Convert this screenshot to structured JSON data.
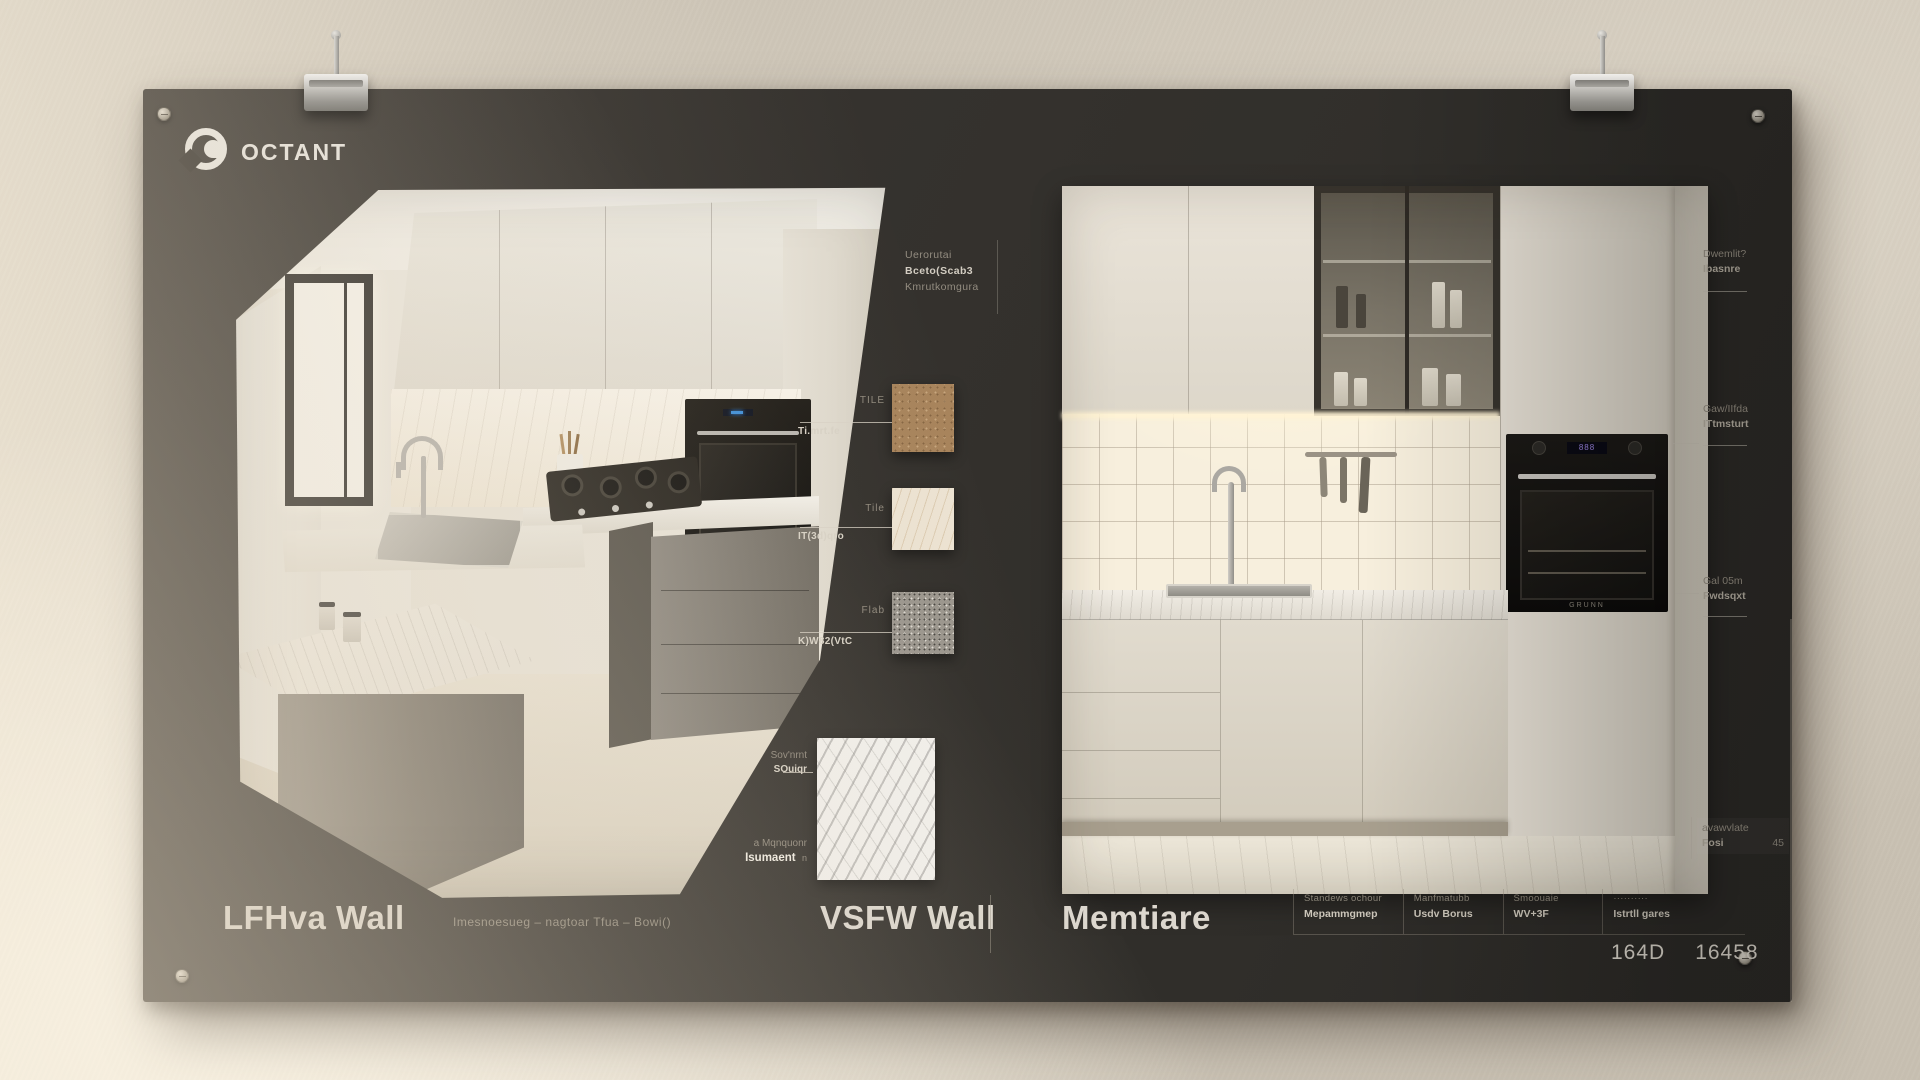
{
  "brand": {
    "logo_text": "OCTANT"
  },
  "colors": {
    "board": "#34312d",
    "wall": "#cfc7ba",
    "light_beam": "#efe7d8"
  },
  "top_annotation": {
    "line1": "Uerorutai",
    "line2": "Bceto(Scab3",
    "line3": "Kmrutkomgura"
  },
  "swatches": {
    "items": [
      {
        "label": "TILE",
        "note": "Ti.mrt.fe",
        "material": "cork"
      },
      {
        "label": "Tile",
        "note": "IT(3d)qro",
        "material": "cream-marble"
      },
      {
        "label": "Flab",
        "note": "K)W82(VtC",
        "material": "granite"
      }
    ],
    "marble": {
      "top1": "Sov'nrnt",
      "top2": "SOuiqr",
      "bottom1": "a Mqnquonr",
      "bottom2": "Isumaent",
      "bottom3": "n",
      "material": "white-marble"
    }
  },
  "right_labels": [
    {
      "line1": "Dwemlit?",
      "line2": "Ibasnre"
    },
    {
      "line1": "Gaw/IIfda",
      "line2": "ITtmsturt"
    },
    {
      "line1": "Gal 05m",
      "line2": "Fwdsqxt"
    },
    {
      "line1": "avawvlate",
      "line2": "Fosi",
      "value": "45"
    }
  ],
  "captions": {
    "left_title": "LFHva Wall",
    "left_subtitle": "Imesnoesueg –  nagtoar Tfua –  Bowi()",
    "mid_title": "VSFW Wall",
    "right_title": "Memtiare"
  },
  "spec_table": {
    "columns": [
      {
        "line1": "Standews ochour",
        "line2": "Mepammgmep"
      },
      {
        "line1": "Manfmatubb",
        "line2": "Usdv Borus"
      },
      {
        "line1": "Smoouaie",
        "line2": "WV+3F"
      },
      {
        "line1": "··········",
        "line2": "Istrtll gares"
      }
    ]
  },
  "figures": {
    "num1": "164D",
    "num2": "16458"
  },
  "right_oven": {
    "brand_text": "GRUNN"
  }
}
